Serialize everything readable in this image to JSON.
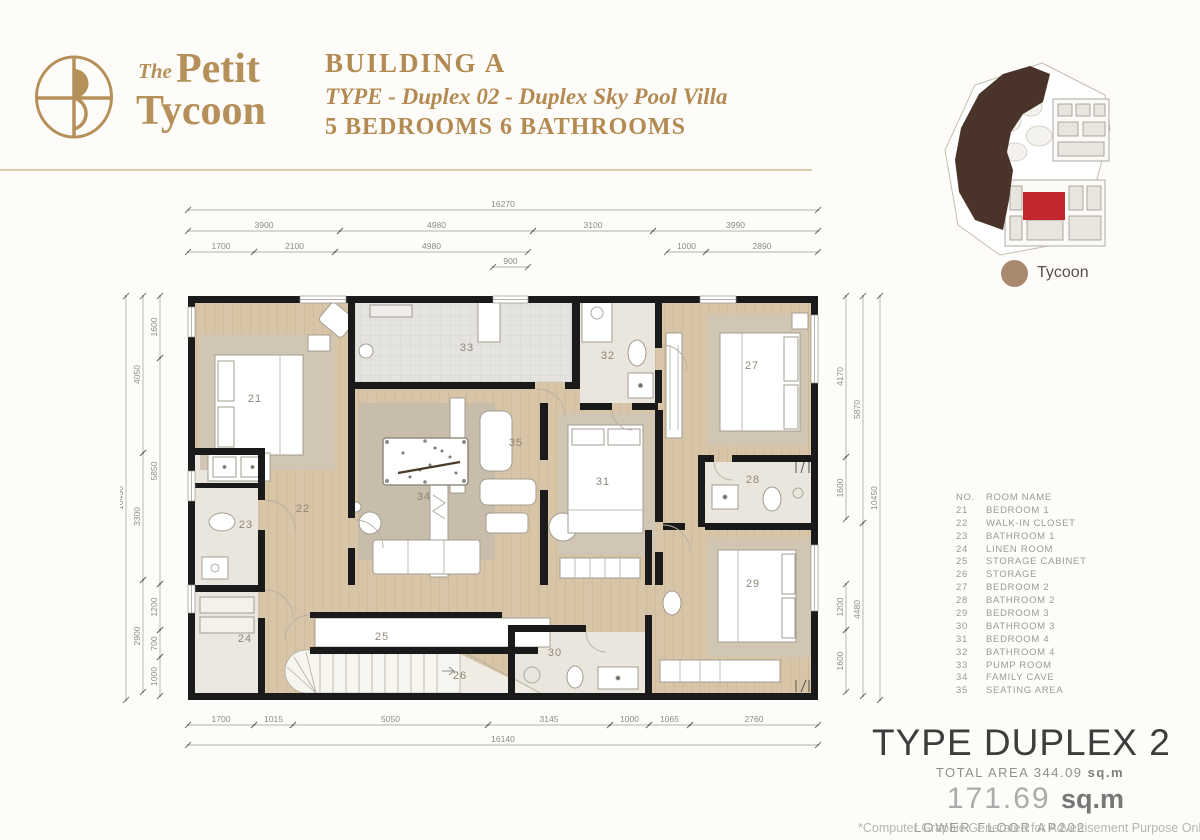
{
  "header": {
    "brand_the": "The",
    "brand_petit": "Petit",
    "brand_tycoon": "Tycoon",
    "building": "BUILDING A",
    "type_line": "TYPE - Duplex 02 - Duplex Sky Pool Villa",
    "beds_line": "5 BEDROOMS 6 BATHROOMS"
  },
  "site_plan": {
    "legend_label": "Tycoon",
    "highlight_color": "#c1272d",
    "mass_color": "#4a3328",
    "legend_dot_color": "#a8896e"
  },
  "legend": {
    "col_no": "NO.",
    "col_name": "ROOM NAME",
    "items": [
      {
        "no": "21",
        "name": "BEDROOM 1"
      },
      {
        "no": "22",
        "name": "WALK-IN CLOSET"
      },
      {
        "no": "23",
        "name": "BATHROOM 1"
      },
      {
        "no": "24",
        "name": "LINEN ROOM"
      },
      {
        "no": "25",
        "name": "STORAGE CABINET"
      },
      {
        "no": "26",
        "name": "STORAGE"
      },
      {
        "no": "27",
        "name": "BEDROOM 2"
      },
      {
        "no": "28",
        "name": "BATHROOM 2"
      },
      {
        "no": "29",
        "name": "BEDROOM 3"
      },
      {
        "no": "30",
        "name": "BATHROOM 3"
      },
      {
        "no": "31",
        "name": "BEDROOM 4"
      },
      {
        "no": "32",
        "name": "BATHROOM 4"
      },
      {
        "no": "33",
        "name": "PUMP ROOM"
      },
      {
        "no": "34",
        "name": "FAMILY CAVE"
      },
      {
        "no": "35",
        "name": "SEATING AREA"
      }
    ]
  },
  "plan": {
    "room_numbers": [
      "21",
      "22",
      "23",
      "24",
      "25",
      "26",
      "27",
      "28",
      "29",
      "30",
      "31",
      "32",
      "33",
      "34",
      "35"
    ],
    "dimensions": {
      "top": [
        "16270",
        "3900",
        "4980",
        "3100",
        "3990",
        "1700",
        "2100",
        "4980",
        "900",
        "1000",
        "2890"
      ],
      "left": [
        "10450",
        "4050",
        "3300",
        "2900",
        "1600",
        "5850",
        "1200",
        "700",
        "1000"
      ],
      "right": [
        "10450",
        "5870",
        "4480",
        "4170",
        "1600",
        "1200",
        "1600"
      ],
      "bottom": [
        "16140",
        "1700",
        "1015",
        "5050",
        "3145",
        "1000",
        "1065",
        "2760"
      ]
    }
  },
  "type_info": {
    "title": "TYPE DUPLEX 2",
    "total_label": "TOTAL AREA",
    "total_value": "344.09",
    "total_unit": "sq.m",
    "area_value": "171.69",
    "area_unit": "sq.m",
    "floor_label": "LOWER FLOOR",
    "floor_code": "AP202",
    "disclaimer": "*Computer Graphic Generated for Advertisement Purpose Only"
  },
  "colors": {
    "gold": "#b28a52",
    "wall": "#1a1a1a",
    "wood_floor": "#d8c5a7",
    "background": "#fdfcf8"
  }
}
